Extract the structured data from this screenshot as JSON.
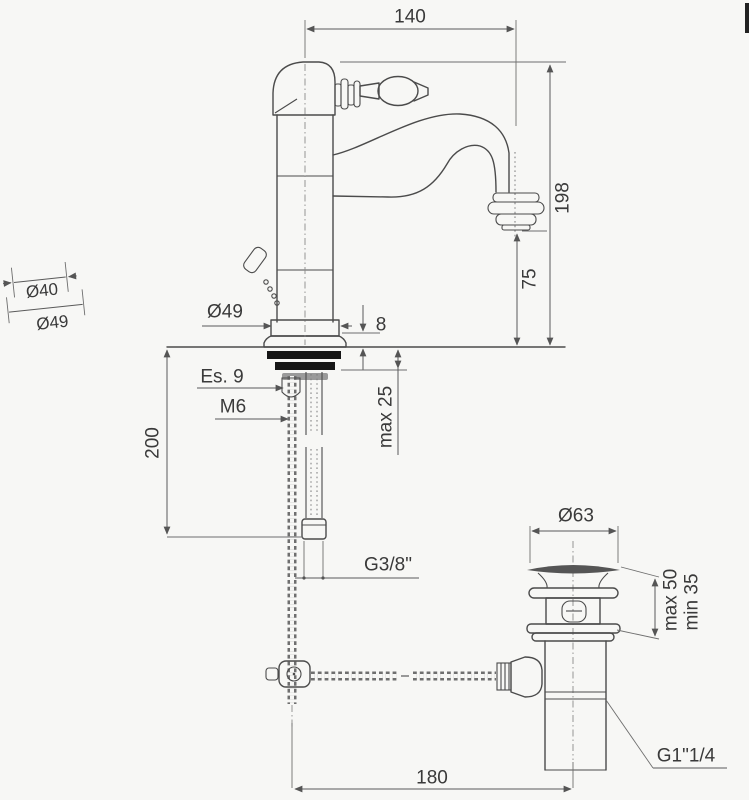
{
  "page": {
    "background": "#f7f7f5",
    "line_color": "#4b4b4b",
    "dimension_color": "#5a5a5a",
    "text_color": "#3a3a3a"
  },
  "drawing": {
    "subject": "single-hole basin mixer with pop-up waste, dimensional drawing",
    "labels": {
      "spout_reach": "140",
      "height_total": "198",
      "spout_height": "75",
      "base_dia": "Ø49",
      "escutcheon_height": "8",
      "hex_size": "Es. 9",
      "stud_thread": "M6",
      "hose_drop": "200",
      "deck_max": "max 25",
      "hose_thread": "G3/8\"",
      "waste_dia": "Ø63",
      "waste_max": "max 50",
      "waste_min": "min 35",
      "waste_thread": "G1\"1/4",
      "rod_to_waste": "180",
      "handle_dia_top": "Ø40",
      "handle_dia_bottom": "Ø49"
    }
  }
}
